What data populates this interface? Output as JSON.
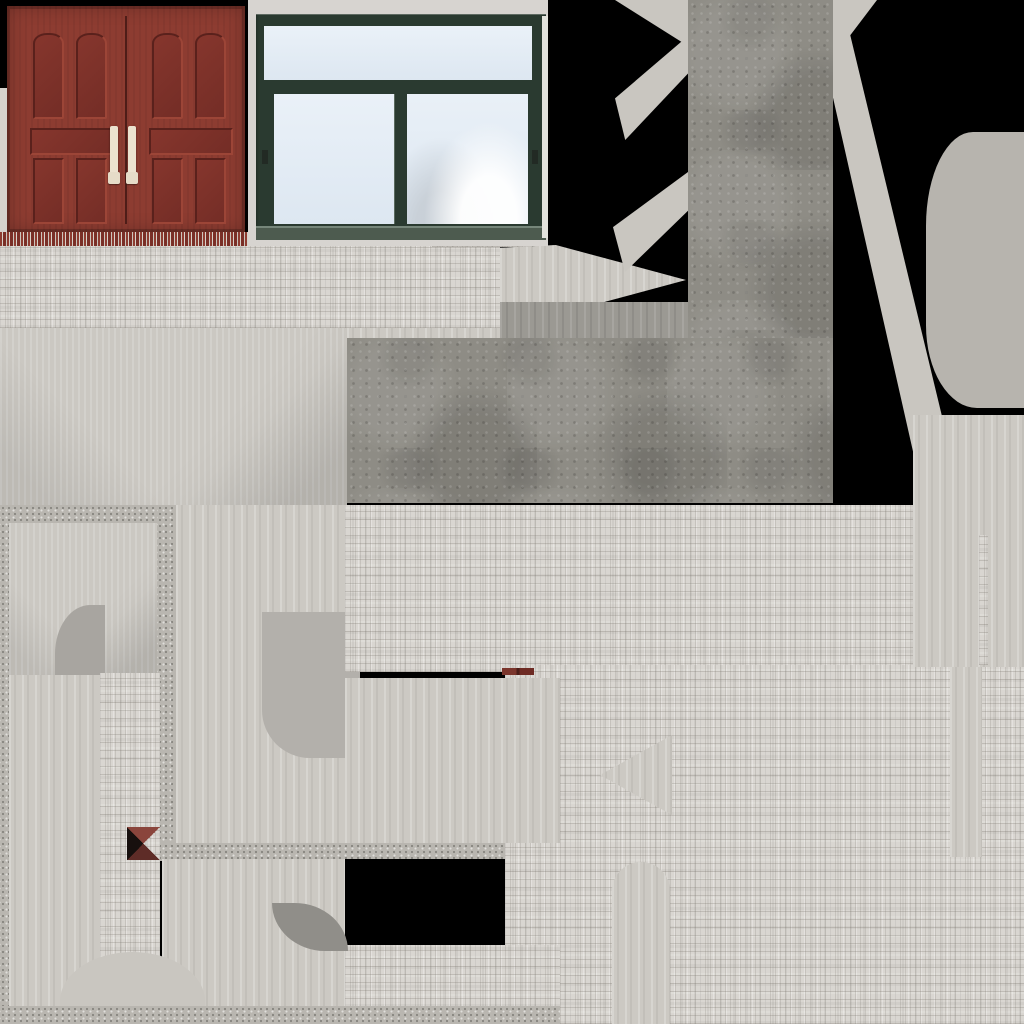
{
  "meta": {
    "kind": "building-texture-atlas",
    "canvas": {
      "width": 1024,
      "height": 1024
    }
  },
  "palette": {
    "atlas_bg": "#000000",
    "brick": "#d9d6d1",
    "concrete": "#8e8c85",
    "granite": "#b9b6b0",
    "pad": "#ccc9c3",
    "pad_dark": "#9b9993",
    "blob": "#b7b4ae",
    "accent_red": "#6e2b24",
    "bowtie_black": "#17100e",
    "bowtie_red": "#8a453c",
    "door": {
      "frame": "#8d3c31",
      "panel": "#7e332b",
      "groove": "#5a211c",
      "highlight": "#9c4537",
      "handle": "#ece2cf"
    },
    "window": {
      "wall": "#d7d4d0",
      "frame": "#2a3a30",
      "glass": "#e9f0f7",
      "edge": "#e2e2dc"
    }
  },
  "atlas": {
    "regions": [
      {
        "name": "brick-band-top",
        "x": 0,
        "y": 245,
        "w": 500,
        "h": 83,
        "tex": "brick"
      },
      {
        "name": "brick-band-notch",
        "x": 432,
        "y": 237,
        "w": 100,
        "h": 10,
        "tex": "brick"
      },
      {
        "name": "pad-arrow-right",
        "x": 500,
        "y": 245,
        "w": 186,
        "h": 70,
        "tex": "pad",
        "clip": "polygon(0 4%, 30% 0, 100% 50%, 30% 100%, 0 94%)"
      },
      {
        "name": "pad-dark-strip",
        "x": 500,
        "y": 302,
        "w": 190,
        "h": 36,
        "tex": "pad-dark"
      },
      {
        "name": "pad-fan-below-band",
        "x": 0,
        "y": 328,
        "w": 347,
        "h": 177,
        "tex": "fan"
      },
      {
        "name": "pad-strip-above-concrete",
        "x": 347,
        "y": 328,
        "w": 153,
        "h": 12,
        "tex": "pad"
      },
      {
        "name": "concrete-strip-vertical",
        "x": 688,
        "y": 0,
        "w": 145,
        "h": 498,
        "tex": "concrete"
      },
      {
        "name": "concrete-block",
        "x": 347,
        "y": 338,
        "w": 486,
        "h": 165,
        "tex": "concrete"
      },
      {
        "name": "pad-wedge-top-left",
        "x": 615,
        "y": 0,
        "w": 73,
        "h": 46,
        "tex": "pad-plain",
        "clip": "polygon(0 0, 100% 0, 100% 100%)"
      },
      {
        "name": "pad-diag-left-upper",
        "x": 615,
        "y": 36,
        "w": 73,
        "h": 104,
        "tex": "pad-plain",
        "clip": "polygon(100% 0, 100% 36%, 14% 100%, 0 60%)"
      },
      {
        "name": "pad-diag-left-lower",
        "x": 613,
        "y": 170,
        "w": 75,
        "h": 102,
        "tex": "pad-plain",
        "clip": "polygon(100% 2%, 100% 40%, 16% 100%, 0 56%)"
      },
      {
        "name": "pad-wedge-top-right",
        "x": 833,
        "y": 0,
        "w": 44,
        "h": 58,
        "tex": "pad-plain",
        "clip": "polygon(0 0, 100% 0, 0 100%)"
      },
      {
        "name": "pad-diag-right",
        "x": 833,
        "y": 24,
        "w": 112,
        "h": 460,
        "tex": "pad-plain",
        "clip": "polygon(0 0, 0 16%, 78% 100%, 100% 100%, 100% 88%, 13% 0)"
      },
      {
        "name": "blob-right",
        "x": 926,
        "y": 132,
        "w": 98,
        "h": 276,
        "tex": "flat",
        "bg": "#b7b4ae",
        "radius": "48% 0 0 52% / 34% 0 0 30%"
      },
      {
        "name": "granite-left-column",
        "x": 0,
        "y": 505,
        "w": 9,
        "h": 519,
        "tex": "granite"
      },
      {
        "name": "granite-top-strip",
        "x": 0,
        "y": 505,
        "w": 168,
        "h": 18,
        "tex": "granite"
      },
      {
        "name": "granite-mid-column",
        "x": 157,
        "y": 505,
        "w": 19,
        "h": 356,
        "tex": "granite"
      },
      {
        "name": "granite-mid-strip",
        "x": 157,
        "y": 843,
        "w": 378,
        "h": 16,
        "tex": "granite"
      },
      {
        "name": "pad-frame-inner",
        "x": 9,
        "y": 523,
        "w": 148,
        "h": 152,
        "tex": "fan"
      },
      {
        "name": "pad-left-column",
        "x": 9,
        "y": 675,
        "w": 91,
        "h": 331,
        "tex": "pad"
      },
      {
        "name": "shape-dark-quarter",
        "x": 55,
        "y": 605,
        "w": 50,
        "h": 70,
        "tex": "flat",
        "bg": "#a8a5a0",
        "radius": "70% 0 0 0"
      },
      {
        "name": "pad-center-column",
        "x": 176,
        "y": 505,
        "w": 169,
        "h": 338,
        "tex": "pad"
      },
      {
        "name": "shape-rounded-block",
        "x": 262,
        "y": 612,
        "w": 98,
        "h": 146,
        "tex": "flat",
        "bg": "#b3b0ab",
        "radius": "0 0 0 48px"
      },
      {
        "name": "brick-column-left",
        "x": 100,
        "y": 673,
        "w": 60,
        "h": 334,
        "tex": "brick"
      },
      {
        "name": "brick-band-mid",
        "x": 345,
        "y": 505,
        "w": 568,
        "h": 167,
        "tex": "brick"
      },
      {
        "name": "brick-bottom-right",
        "x": 505,
        "y": 665,
        "w": 519,
        "h": 359,
        "tex": "brick"
      },
      {
        "name": "pad-below-mid",
        "x": 345,
        "y": 678,
        "w": 215,
        "h": 165,
        "tex": "pad"
      },
      {
        "name": "pad-right-column",
        "x": 913,
        "y": 415,
        "w": 111,
        "h": 252,
        "tex": "pad"
      },
      {
        "name": "brick-sliver-right",
        "x": 979,
        "y": 535,
        "w": 9,
        "h": 130,
        "tex": "brick"
      },
      {
        "name": "pad-chevron-notch",
        "x": 600,
        "y": 735,
        "w": 72,
        "h": 80,
        "tex": "pad",
        "clip": "polygon(100% 0, 0 50%, 100% 100%)"
      },
      {
        "name": "pad-column-bottom-right",
        "x": 950,
        "y": 667,
        "w": 32,
        "h": 190,
        "tex": "pad"
      },
      {
        "name": "shape-arch",
        "x": 612,
        "y": 862,
        "w": 58,
        "h": 162,
        "tex": "pad",
        "radius": "29px 29px 0 0"
      },
      {
        "name": "brick-band-bottom",
        "x": 345,
        "y": 945,
        "w": 215,
        "h": 62,
        "tex": "brick"
      },
      {
        "name": "pad-bottom-mid",
        "x": 162,
        "y": 859,
        "w": 183,
        "h": 147,
        "tex": "pad"
      },
      {
        "name": "shape-blob-bottom-left",
        "x": 60,
        "y": 952,
        "w": 145,
        "h": 58,
        "tex": "flat",
        "bg": "#c9c6c0",
        "radius": "50% 50% 0 0 / 85% 85% 0 0"
      },
      {
        "name": "shape-dark-blob",
        "x": 272,
        "y": 903,
        "w": 76,
        "h": 48,
        "tex": "flat",
        "bg": "#908e89",
        "radius": "0 70% 0 70% / 0 100% 0 100%"
      },
      {
        "name": "granite-bottom-strip",
        "x": 0,
        "y": 1006,
        "w": 560,
        "h": 18,
        "tex": "granite"
      },
      {
        "name": "marker-red-dash",
        "x": 502,
        "y": 668,
        "w": 32,
        "h": 7,
        "tex": "flat",
        "bg": "linear-gradient(90deg,#7a352c 0 45%,#4a1d18 45% 55%,#6e2b24 55% 100%)"
      },
      {
        "name": "marker-bowtie",
        "x": 127,
        "y": 827,
        "w": 33,
        "h": 33,
        "tex": "flat",
        "bg": "conic-gradient(from 45deg, rgba(0,0,0,0) 0 90deg, #5e2c27 90deg 180deg, #17100e 180deg 270deg, #8a453c 270deg 360deg)"
      }
    ]
  },
  "door_panels": [
    {
      "x": 26,
      "y": 27,
      "w": 27,
      "h": 82,
      "arch": true
    },
    {
      "x": 69,
      "y": 27,
      "w": 27,
      "h": 82,
      "arch": true
    },
    {
      "x": 145,
      "y": 27,
      "w": 27,
      "h": 82,
      "arch": true
    },
    {
      "x": 188,
      "y": 27,
      "w": 27,
      "h": 82,
      "arch": true
    },
    {
      "x": 23,
      "y": 122,
      "w": 80,
      "h": 23,
      "arch": false
    },
    {
      "x": 142,
      "y": 122,
      "w": 80,
      "h": 23,
      "arch": false
    },
    {
      "x": 26,
      "y": 152,
      "w": 27,
      "h": 62,
      "arch": false
    },
    {
      "x": 69,
      "y": 152,
      "w": 27,
      "h": 62,
      "arch": false
    },
    {
      "x": 145,
      "y": 152,
      "w": 27,
      "h": 62,
      "arch": false
    },
    {
      "x": 188,
      "y": 152,
      "w": 27,
      "h": 62,
      "arch": false
    }
  ]
}
